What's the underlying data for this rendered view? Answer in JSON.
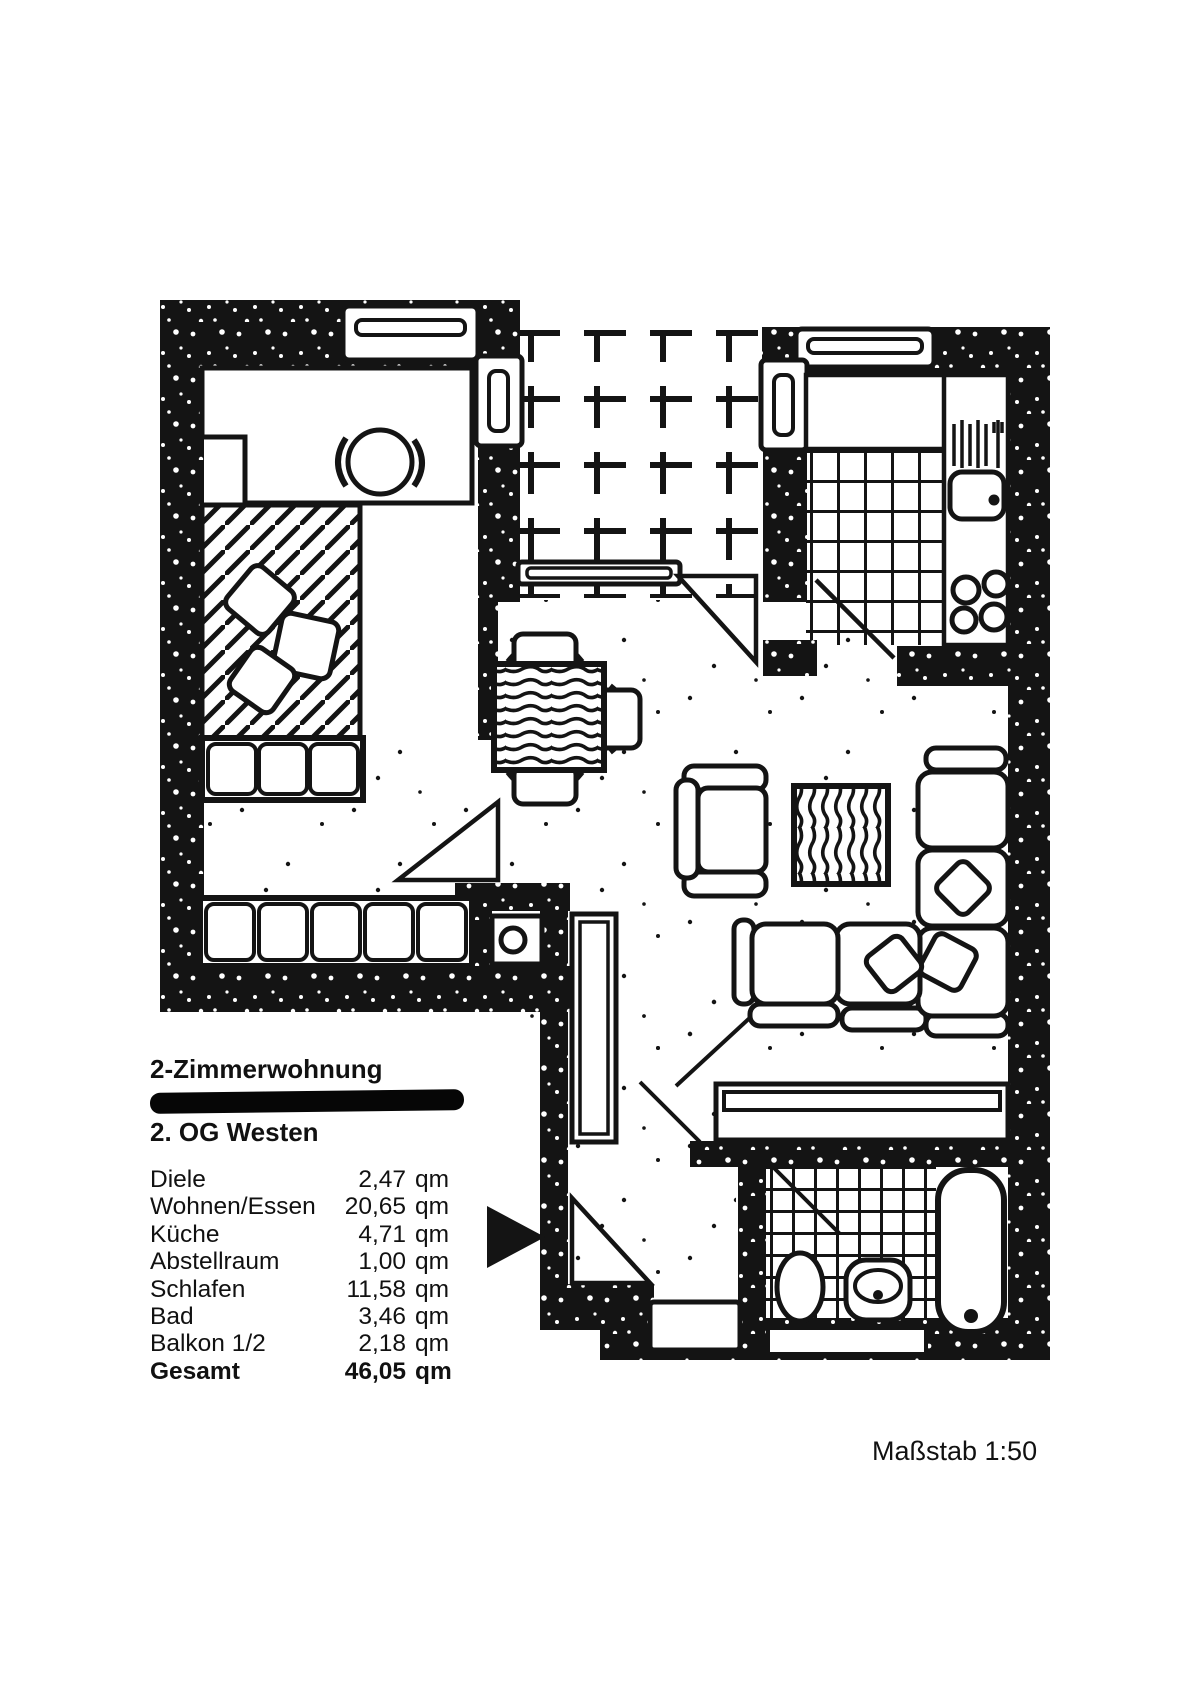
{
  "document": {
    "title": "2-Zimmerwohnung",
    "floor_line": "2. OG Westen",
    "scale_label": "Maßstab 1:50",
    "redacted_line_present": true
  },
  "area_table": {
    "unit": "qm",
    "rows": [
      {
        "label": "Diele",
        "value": "2,47"
      },
      {
        "label": "Wohnen/Essen",
        "value": "20,65"
      },
      {
        "label": "Küche",
        "value": "4,71"
      },
      {
        "label": "Abstellraum",
        "value": "1,00"
      },
      {
        "label": "Schlafen",
        "value": "11,58"
      },
      {
        "label": "Bad",
        "value": "3,46"
      },
      {
        "label": "Balkon 1/2",
        "value": "2,18"
      },
      {
        "label": "Gesamt",
        "value": "46,05"
      }
    ]
  },
  "floorplan": {
    "rooms": [
      "Schlafen",
      "Balkon",
      "Küche",
      "Wohnen/Essen",
      "Abstellraum",
      "Diele",
      "Bad"
    ],
    "colors": {
      "ink": "#141414",
      "paper": "#ffffff"
    }
  }
}
